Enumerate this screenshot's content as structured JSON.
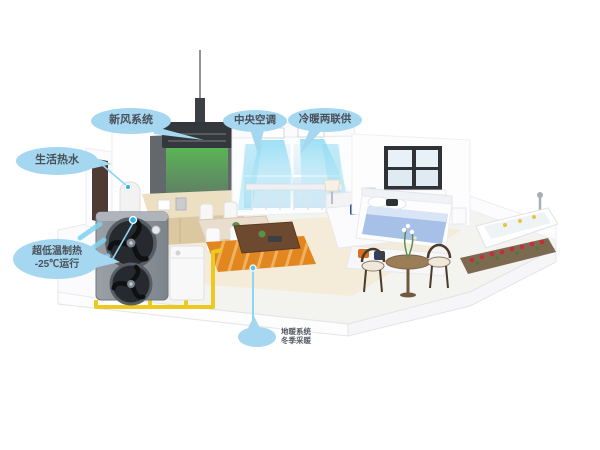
{
  "callouts": {
    "fresh_air": {
      "label": "新风系统"
    },
    "hot_water": {
      "label": "生活热水"
    },
    "central_ac": {
      "label": "中央空调"
    },
    "heating_cooling": {
      "label": "冷暖两联供"
    },
    "low_temp": {
      "line1": "超低温制热",
      "line2": "-25℃运行"
    },
    "floor_heating": {
      "line1": "地暖系统",
      "line2": "冬季采暖"
    }
  },
  "colors": {
    "background": "#ffffff",
    "callout_bubble": "#a5d7f1",
    "callout_text": "#4a5058",
    "connector_line": "#8ed5f2",
    "pipe_yellow": "#edc91f",
    "floor_heating_orange": "#e2861f",
    "airflow_cyan": "#7fd6f2",
    "fresh_air_green": "#57d24b",
    "heat_pump_gray": "#8a9096",
    "bedding_blue": "#a6c0e8",
    "flower_red": "#c92b3a"
  }
}
